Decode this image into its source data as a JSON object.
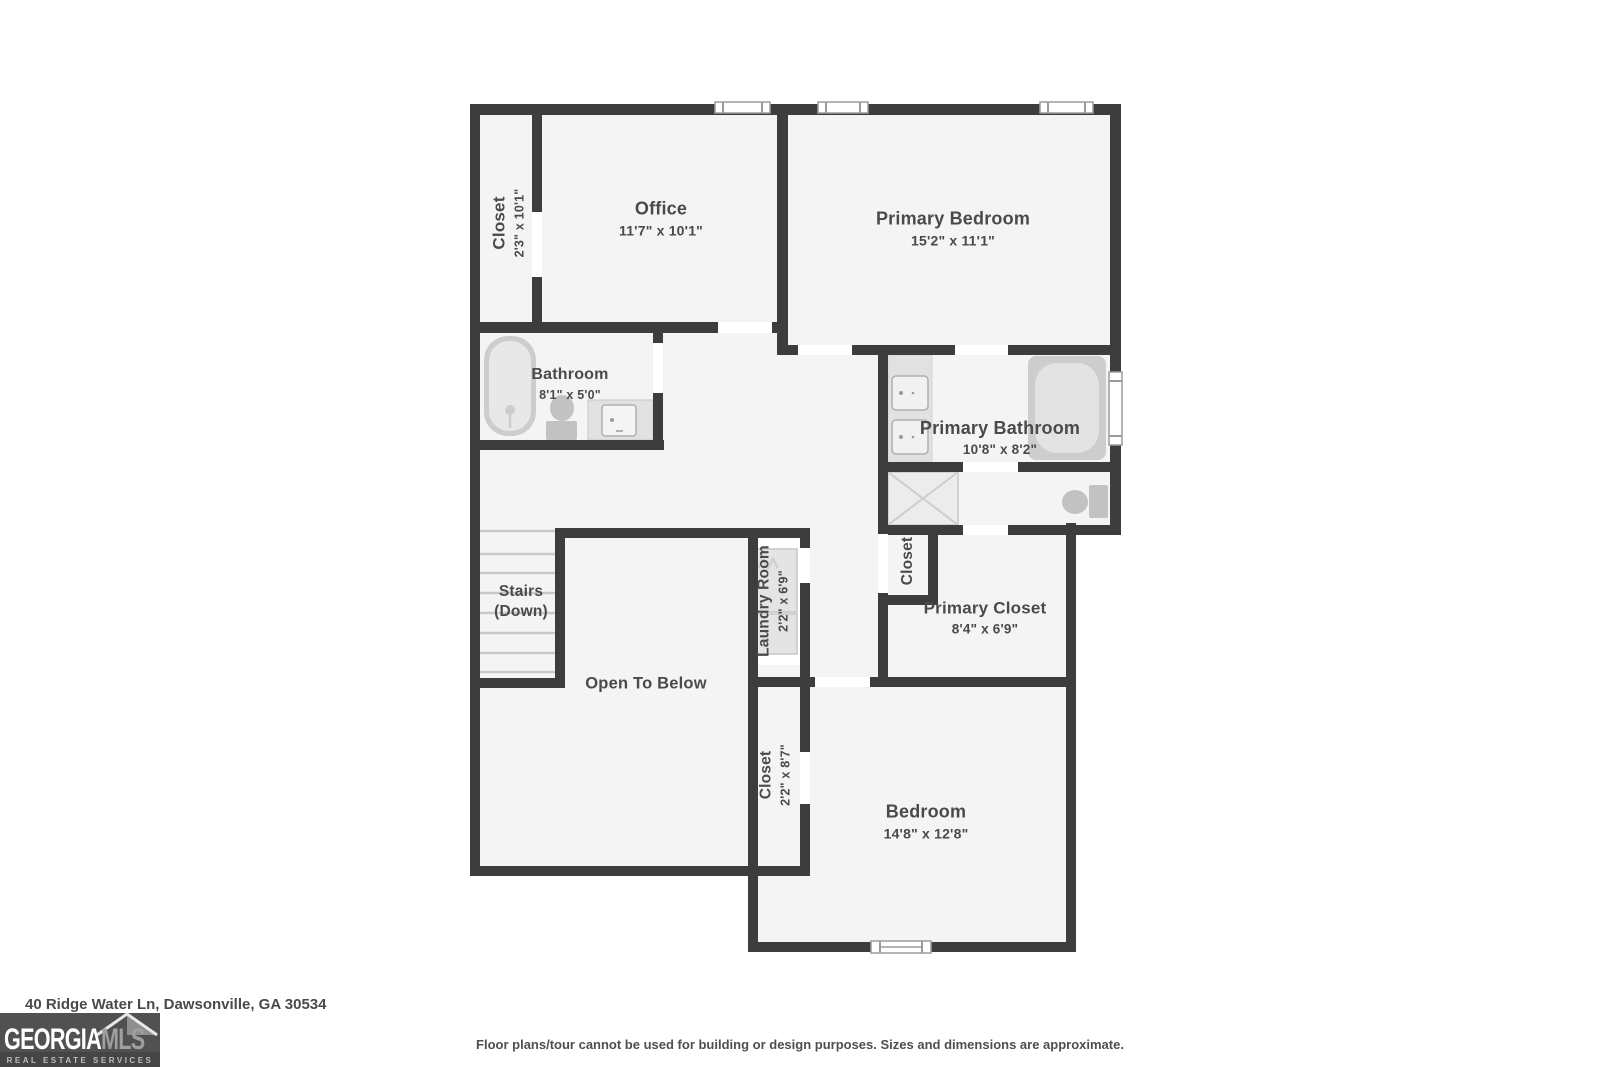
{
  "plan": {
    "rooms": {
      "closet_top_left": {
        "label": "Closet",
        "dims": "2'3\" x 10'1\""
      },
      "office": {
        "label": "Office",
        "dims": "11'7\" x 10'1\""
      },
      "primary_bedroom": {
        "label": "Primary Bedroom",
        "dims": "15'2\" x 11'1\""
      },
      "bathroom": {
        "label": "Bathroom",
        "dims": "8'1\" x 5'0\""
      },
      "primary_bathroom": {
        "label": "Primary Bathroom",
        "dims": "10'8\" x 8'2\""
      },
      "stairs": {
        "label": "Stairs",
        "sublabel": "(Down)"
      },
      "open_to_below": {
        "label": "Open To Below"
      },
      "laundry_room": {
        "label": "Laundry Room",
        "dims": "2'2\" x 6'9\""
      },
      "hall_closet": {
        "label": "Closet"
      },
      "primary_closet": {
        "label": "Primary Closet",
        "dims": "8'4\" x 6'9\""
      },
      "bedroom_closet": {
        "label": "Closet",
        "dims": "2'2\" x 8'7\""
      },
      "bedroom": {
        "label": "Bedroom",
        "dims": "14'8\" x 12'8\""
      }
    },
    "colors": {
      "wall": "#3d3d3d",
      "floor": "#f4f4f4",
      "fixture": "#cdcdcd",
      "fixture_light": "#e3e3e3",
      "label_text": "#4a4a4a",
      "window_frame": "#9b9b9b"
    }
  },
  "footer": {
    "address": "40 Ridge Water Ln, Dawsonville, GA 30534",
    "disclaimer": "Floor plans/tour cannot be used for building or design purposes. Sizes and dimensions are approximate."
  },
  "logo": {
    "brand_primary": "GEORGIA",
    "brand_secondary": "MLS",
    "tagline": "REAL ESTATE SERVICES"
  }
}
